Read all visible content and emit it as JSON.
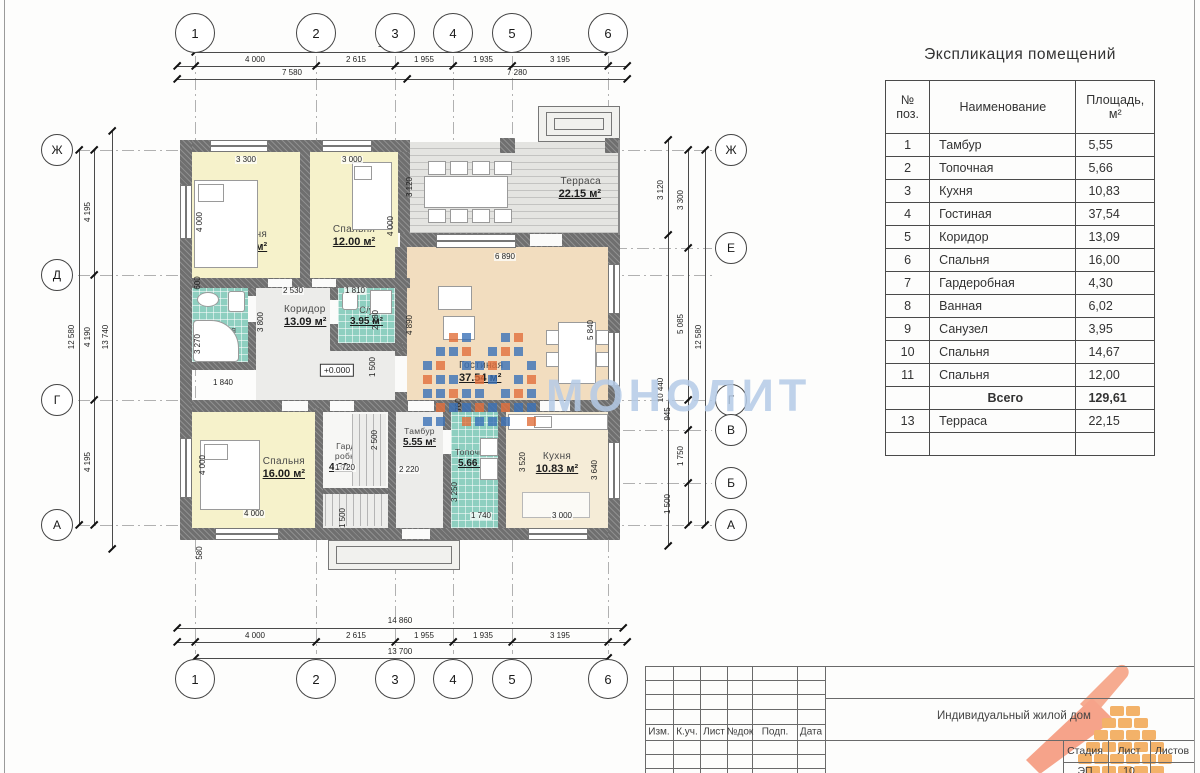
{
  "watermark": {
    "text": "МОНОЛИТ",
    "text_color": "#b5cbe7",
    "mosaic_blue": "#3b72b8",
    "mosaic_orange": "#e2703c"
  },
  "explication": {
    "title": "Экспликация помещений",
    "headers": {
      "num1": "№",
      "num2": "поз.",
      "name": "Наименование",
      "area1": "Площадь,",
      "area2": "м²"
    },
    "rows": [
      {
        "num": "1",
        "name": "Тамбур",
        "area": "5,55"
      },
      {
        "num": "2",
        "name": "Топочная",
        "area": "5,66"
      },
      {
        "num": "3",
        "name": "Кухня",
        "area": "10,83"
      },
      {
        "num": "4",
        "name": "Гостиная",
        "area": "37,54"
      },
      {
        "num": "5",
        "name": "Коридор",
        "area": "13,09"
      },
      {
        "num": "6",
        "name": "Спальня",
        "area": "16,00"
      },
      {
        "num": "7",
        "name": "Гардеробная",
        "area": "4,30"
      },
      {
        "num": "8",
        "name": "Ванная",
        "area": "6,02"
      },
      {
        "num": "9",
        "name": "Санузел",
        "area": "3,95"
      },
      {
        "num": "10",
        "name": "Спальня",
        "area": "14,67"
      },
      {
        "num": "11",
        "name": "Спальня",
        "area": "12,00"
      },
      {
        "num": "",
        "name": "Всего",
        "area": "129,61",
        "total": true
      },
      {
        "num": "13",
        "name": "Терраса",
        "area": "22,15"
      },
      {
        "num": "",
        "name": "",
        "area": ""
      }
    ]
  },
  "title_block": {
    "revision_columns": [
      "Изм.",
      "К.уч.",
      "Лист",
      "№док",
      "Подп.",
      "Дата"
    ],
    "project_name": "Индивидуальный жилой дом",
    "stage_header": "Стадия",
    "sheet_header": "Лист",
    "sheets_header": "Листов",
    "stage_value": "ЭП",
    "sheet_value": "10",
    "sheets_value": ""
  },
  "rooms": {
    "bedroom1": {
      "name": "Спальня",
      "area": "14.67 м²"
    },
    "bedroom2": {
      "name": "Спальня",
      "area": "12.00 м²"
    },
    "bedroom3": {
      "name": "Спальня",
      "area": "16.00 м²"
    },
    "bathroom": {
      "name": "Ванная",
      "area": "6.02 м²"
    },
    "wc": {
      "name": "С/у",
      "area": "3.95 м²"
    },
    "corridor": {
      "name": "Коридор",
      "area": "13.09 м²"
    },
    "wardrobe": {
      "name": "Гарде-робная",
      "area": "4.30 м²"
    },
    "tambur": {
      "name": "Тамбур",
      "area": "5.55 м²"
    },
    "boiler": {
      "name": "Топочная",
      "area": "5.66 м²"
    },
    "kitchen": {
      "name": "Кухня",
      "area": "10.83 м²"
    },
    "living": {
      "name": "Гостиная",
      "area": "37.54 м²"
    },
    "terrace": {
      "name": "Терраса",
      "area": "22.15 м²"
    }
  },
  "axes": {
    "top": {
      "cy": 33,
      "r": 20,
      "items": [
        {
          "label": "1",
          "x": 195
        },
        {
          "label": "2",
          "x": 316
        },
        {
          "label": "3",
          "x": 395
        },
        {
          "label": "4",
          "x": 453
        },
        {
          "label": "5",
          "x": 512
        },
        {
          "label": "6",
          "x": 608
        }
      ]
    },
    "bottom": {
      "cy": 679,
      "r": 20,
      "items": [
        {
          "label": "1",
          "x": 195
        },
        {
          "label": "2",
          "x": 316
        },
        {
          "label": "3",
          "x": 395
        },
        {
          "label": "4",
          "x": 453
        },
        {
          "label": "5",
          "x": 512
        },
        {
          "label": "6",
          "x": 608
        }
      ]
    },
    "left": {
      "cx": 57,
      "r": 16,
      "items": [
        {
          "label": "Ж",
          "y": 150
        },
        {
          "label": "Д",
          "y": 275
        },
        {
          "label": "Г",
          "y": 400
        },
        {
          "label": "А",
          "y": 525
        }
      ]
    },
    "right": {
      "cx": 731,
      "r": 16,
      "items": [
        {
          "label": "Ж",
          "y": 150
        },
        {
          "label": "Е",
          "y": 248
        },
        {
          "label": "Г",
          "y": 400
        },
        {
          "label": "В",
          "y": 430
        },
        {
          "label": "Б",
          "y": 483
        },
        {
          "label": "А",
          "y": 525
        }
      ]
    }
  },
  "dims": [
    {
      "t": "13 700",
      "x": 390,
      "y": 45
    },
    {
      "t": "4 000",
      "x": 255,
      "y": 60
    },
    {
      "t": "2 615",
      "x": 356,
      "y": 60
    },
    {
      "t": "1 955",
      "x": 424,
      "y": 60
    },
    {
      "t": "1 935",
      "x": 483,
      "y": 60
    },
    {
      "t": "3 195",
      "x": 560,
      "y": 60
    },
    {
      "t": "7 580",
      "x": 292,
      "y": 73
    },
    {
      "t": "7 280",
      "x": 517,
      "y": 73
    },
    {
      "t": "14 860",
      "x": 400,
      "y": 621
    },
    {
      "t": "4 000",
      "x": 255,
      "y": 636
    },
    {
      "t": "2 615",
      "x": 356,
      "y": 636
    },
    {
      "t": "1 955",
      "x": 424,
      "y": 636
    },
    {
      "t": "1 935",
      "x": 483,
      "y": 636
    },
    {
      "t": "3 195",
      "x": 560,
      "y": 636
    },
    {
      "t": "13 700",
      "x": 400,
      "y": 652
    },
    {
      "t": "12 580",
      "x": 72,
      "y": 337,
      "v": 1
    },
    {
      "t": "4 195",
      "x": 88,
      "y": 212,
      "v": 1
    },
    {
      "t": "4 190",
      "x": 88,
      "y": 337,
      "v": 1
    },
    {
      "t": "4 195",
      "x": 88,
      "y": 462,
      "v": 1
    },
    {
      "t": "13 740",
      "x": 106,
      "y": 337,
      "v": 1
    },
    {
      "t": "3 120",
      "x": 661,
      "y": 190,
      "v": 1
    },
    {
      "t": "10 440",
      "x": 661,
      "y": 390,
      "v": 1
    },
    {
      "t": "3 300",
      "x": 681,
      "y": 200,
      "v": 1
    },
    {
      "t": "5 085",
      "x": 681,
      "y": 324,
      "v": 1
    },
    {
      "t": "945",
      "x": 668,
      "y": 414,
      "v": 1
    },
    {
      "t": "1 750",
      "x": 681,
      "y": 456,
      "v": 1
    },
    {
      "t": "1 500",
      "x": 668,
      "y": 504,
      "v": 1
    },
    {
      "t": "12 580",
      "x": 699,
      "y": 337,
      "v": 1
    },
    {
      "t": "3 300",
      "x": 246,
      "y": 160
    },
    {
      "t": "3 000",
      "x": 352,
      "y": 160
    },
    {
      "t": "4 000",
      "x": 200,
      "y": 222,
      "v": 1
    },
    {
      "t": "4 000",
      "x": 391,
      "y": 226,
      "v": 1
    },
    {
      "t": "600",
      "x": 198,
      "y": 283,
      "v": 1
    },
    {
      "t": "2 530",
      "x": 293,
      "y": 291
    },
    {
      "t": "1 810",
      "x": 355,
      "y": 291
    },
    {
      "t": "3 800",
      "x": 261,
      "y": 322,
      "v": 1
    },
    {
      "t": "2 180",
      "x": 376,
      "y": 320,
      "v": 1
    },
    {
      "t": "3 270",
      "x": 198,
      "y": 344,
      "v": 1
    },
    {
      "t": "1 840",
      "x": 223,
      "y": 383
    },
    {
      "t": "1 500",
      "x": 373,
      "y": 367,
      "v": 1
    },
    {
      "t": "4 890",
      "x": 410,
      "y": 325,
      "v": 1
    },
    {
      "t": "6 890",
      "x": 505,
      "y": 257
    },
    {
      "t": "5 840",
      "x": 591,
      "y": 330,
      "v": 1
    },
    {
      "t": "760",
      "x": 459,
      "y": 405,
      "v": 1
    },
    {
      "t": "2 500",
      "x": 375,
      "y": 440,
      "v": 1
    },
    {
      "t": "1 720",
      "x": 345,
      "y": 468
    },
    {
      "t": "4 000",
      "x": 203,
      "y": 465,
      "v": 1
    },
    {
      "t": "4 000",
      "x": 254,
      "y": 514
    },
    {
      "t": "2 220",
      "x": 409,
      "y": 470
    },
    {
      "t": "3 250",
      "x": 455,
      "y": 492,
      "v": 1
    },
    {
      "t": "1 740",
      "x": 481,
      "y": 516
    },
    {
      "t": "3 520",
      "x": 523,
      "y": 462,
      "v": 1
    },
    {
      "t": "3 000",
      "x": 562,
      "y": 516
    },
    {
      "t": "3 640",
      "x": 595,
      "y": 470,
      "v": 1
    },
    {
      "t": "1 500",
      "x": 343,
      "y": 518,
      "v": 1
    },
    {
      "t": "580",
      "x": 200,
      "y": 553,
      "v": 1
    },
    {
      "t": "3 120",
      "x": 410,
      "y": 187,
      "v": 1
    },
    {
      "t": "+0.000",
      "x": 337,
      "y": 370,
      "b": 1
    }
  ]
}
